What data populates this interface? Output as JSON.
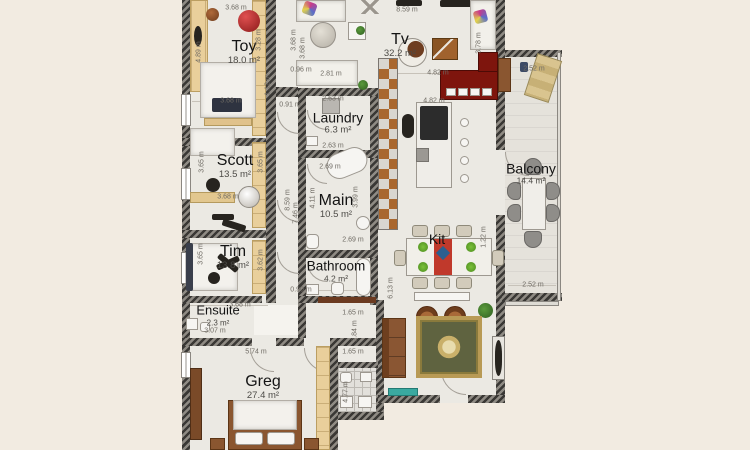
{
  "plan": {
    "rooms": [
      {
        "label": "Toy",
        "area": "18.0 m²"
      },
      {
        "label": "Scott",
        "area": "13.5 m²"
      },
      {
        "label": "Tim",
        "area": "13.8 m²"
      },
      {
        "label": "Ensuite",
        "area": "2.3 m²"
      },
      {
        "label": "Greg",
        "area": "27.4 m²"
      },
      {
        "label": "Laundry",
        "area": "6.3 m²"
      },
      {
        "label": "Main",
        "area": "10.5 m²"
      },
      {
        "label": "Bathroom",
        "area": "4.2 m²"
      },
      {
        "label": "Tv",
        "area": "32.2 m²"
      },
      {
        "label": "Kit",
        "area": ""
      },
      {
        "label": "Balcony",
        "area": "14.4 m²"
      }
    ],
    "dimensions": [
      {
        "text": "3.68 m",
        "x": 236,
        "y": 8
      },
      {
        "text": "4.89 m",
        "x": 199,
        "y": 52,
        "v": true
      },
      {
        "text": "3.28 m",
        "x": 259,
        "y": 40,
        "v": true
      },
      {
        "text": "3.68 m",
        "x": 231,
        "y": 101
      },
      {
        "text": "1.12 m",
        "x": 268,
        "y": 85,
        "v": true
      },
      {
        "text": "0.96 m",
        "x": 301,
        "y": 70
      },
      {
        "text": "0.91 m",
        "x": 290,
        "y": 105
      },
      {
        "text": "3.65 m",
        "x": 202,
        "y": 162,
        "v": true
      },
      {
        "text": "3.65 m",
        "x": 261,
        "y": 162,
        "v": true
      },
      {
        "text": "3.68 m",
        "x": 228,
        "y": 197
      },
      {
        "text": "3.65 m",
        "x": 201,
        "y": 254,
        "v": true
      },
      {
        "text": "3.62 m",
        "x": 261,
        "y": 260,
        "v": true
      },
      {
        "text": "3.68 m",
        "x": 240,
        "y": 305
      },
      {
        "text": "3.07 m",
        "x": 215,
        "y": 331
      },
      {
        "text": "5.74 m",
        "x": 256,
        "y": 352
      },
      {
        "text": "4.77 m",
        "x": 346,
        "y": 392,
        "v": true
      },
      {
        "text": "2.63 m",
        "x": 333,
        "y": 99
      },
      {
        "text": "2.63 m",
        "x": 333,
        "y": 146
      },
      {
        "text": "2.69 m",
        "x": 330,
        "y": 167
      },
      {
        "text": "4.11 m",
        "x": 313,
        "y": 198,
        "v": true
      },
      {
        "text": "3.99 m",
        "x": 356,
        "y": 197,
        "v": true
      },
      {
        "text": "2.69 m",
        "x": 353,
        "y": 240
      },
      {
        "text": "8.59 m",
        "x": 288,
        "y": 200,
        "v": true
      },
      {
        "text": "7.46 m",
        "x": 296,
        "y": 213,
        "v": true
      },
      {
        "text": "8.59 m",
        "x": 407,
        "y": 10
      },
      {
        "text": "3.68 m",
        "x": 294,
        "y": 40,
        "v": true
      },
      {
        "text": "3.68 m",
        "x": 303,
        "y": 48,
        "v": true
      },
      {
        "text": "3.78 m",
        "x": 479,
        "y": 43,
        "v": true
      },
      {
        "text": "2.81 m",
        "x": 331,
        "y": 74
      },
      {
        "text": "4.82 m",
        "x": 438,
        "y": 73
      },
      {
        "text": "4.82 m",
        "x": 434,
        "y": 101
      },
      {
        "text": "1.22 m",
        "x": 484,
        "y": 237,
        "v": true
      },
      {
        "text": "6.13 m",
        "x": 391,
        "y": 288,
        "v": true
      },
      {
        "text": "0.90 m",
        "x": 301,
        "y": 290
      },
      {
        "text": "1.65 m",
        "x": 353,
        "y": 313
      },
      {
        "text": "2.84 m",
        "x": 355,
        "y": 331,
        "v": true
      },
      {
        "text": "1.65 m",
        "x": 353,
        "y": 352
      },
      {
        "text": "2.52 m",
        "x": 533,
        "y": 285
      },
      {
        "text": "2.52 m",
        "x": 534,
        "y": 69
      }
    ]
  },
  "colors": {
    "background": "#f2ebe1",
    "floor": "#ebe9e3",
    "wall": "#3a3835",
    "closet_tan": "#e9cf9b",
    "sofa_red": "#7e150d",
    "wood_brown": "#9a6030",
    "rug_green": "#5f6340",
    "tv_bench_teal": "#3aa9a0"
  }
}
